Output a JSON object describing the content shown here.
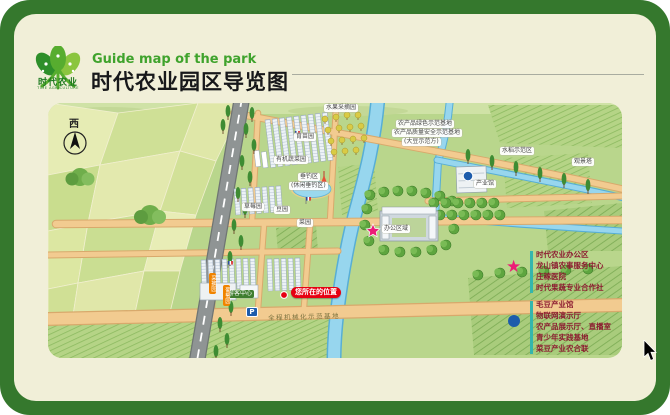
{
  "header": {
    "subtitle": "Guide map of the park",
    "title": "时代农业园区导览图",
    "logo_text": "时代农业",
    "logo_subtext": "TIME AGRICULTURE"
  },
  "map": {
    "compass": "西",
    "labels": {
      "fruit_picking": "水果采摘园",
      "rice_demo": "水稻示范区",
      "tower": "观景塔",
      "seedling": "育苗园",
      "organic_veg": "有机蔬菜园",
      "strawberry": "草莓园",
      "fishing_1": "垂钓区",
      "fishing_2": "(休闲垂钓区)",
      "office": "办公区域",
      "industry_hall": "产业馆",
      "bean_garden": "豆园",
      "veg_garden": "菜园",
      "visitor_center": "游客中心",
      "parking": "P",
      "you_are_here": "您所在的位置",
      "road_text": "全程机械化示范基地",
      "base_line1": "农产品绿色示范基地",
      "base_line2": "农产品质量安全示范基地",
      "base_line3": "(大豆示范方)",
      "picking1": "采摘园",
      "picking2": "葡萄园"
    }
  },
  "legend": {
    "star_items": [
      "时代农业办公区",
      "龙山镇农事服务中心",
      "庄稼医院",
      "时代果蔬专业合作社"
    ],
    "dot_items": [
      "毛豆产业馆",
      "物联网演示厅",
      "农产品展示厅、直播室",
      "青少年实践基地",
      "菜豆产业农合联"
    ]
  },
  "colors": {
    "frame_green": "#35782d",
    "card_cream": "#f1efd8",
    "subtitle_green": "#3fa32c",
    "star_pink": "#ec1c77",
    "dot_blue": "#1d5cab",
    "legend_text": "#8c1b30",
    "badge_red": "#e60012",
    "river_blue": "#97d6ee",
    "road_gray": "#8f9494",
    "path_tan": "#f2cb90"
  }
}
